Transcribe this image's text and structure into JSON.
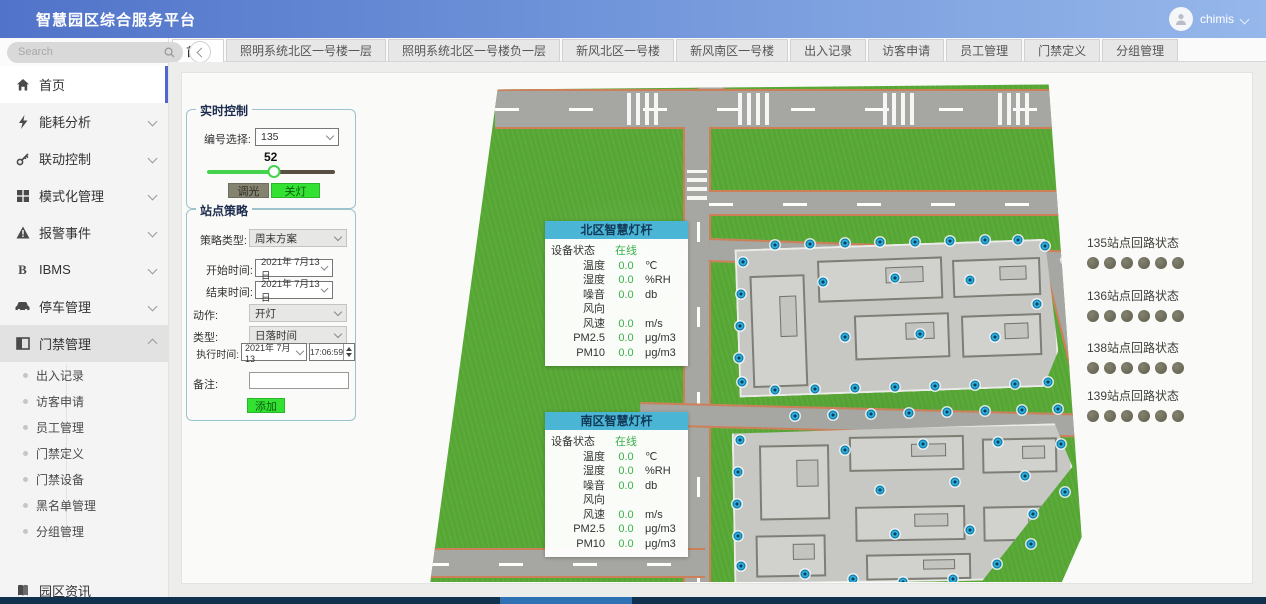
{
  "header": {
    "title": "智慧园区综合服务平台",
    "user_name": "chimis"
  },
  "sidebar": {
    "search_placeholder": "Search",
    "menu": [
      {
        "label": "首页",
        "icon": "home-icon",
        "active": true,
        "expandable": false
      },
      {
        "label": "能耗分析",
        "icon": "bolt-icon",
        "expandable": true
      },
      {
        "label": "联动控制",
        "icon": "key-icon",
        "expandable": true
      },
      {
        "label": "模式化管理",
        "icon": "grid-icon",
        "expandable": true
      },
      {
        "label": "报警事件",
        "icon": "alert-icon",
        "expandable": true
      },
      {
        "label": "IBMS",
        "icon": "ibms-icon",
        "expandable": true
      },
      {
        "label": "停车管理",
        "icon": "car-icon",
        "expandable": true
      },
      {
        "label": "门禁管理",
        "icon": "door-icon",
        "expandable": true,
        "expanded": true
      }
    ],
    "submenu": [
      "出入记录",
      "访客申请",
      "员工管理",
      "门禁定义",
      "门禁设备",
      "黑名单管理",
      "分组管理"
    ],
    "footer_label": "园区资讯"
  },
  "tabs": {
    "active_index": 0,
    "items": [
      "首页",
      "照明系统北区一号楼一层",
      "照明系统北区一号楼负一层",
      "新风北区一号楼",
      "新风南区一号楼",
      "出入记录",
      "访客申请",
      "员工管理",
      "门禁定义",
      "分组管理"
    ]
  },
  "realtime": {
    "title": "实时控制",
    "select_label": "编号选择:",
    "select_value": "135",
    "slider_value": "52",
    "dim_button": "调光",
    "off_button": "关灯"
  },
  "strategy": {
    "title": "站点策略",
    "type_label": "策略类型:",
    "type_value": "周末方案",
    "start_label": "开始时间:",
    "start_value": "2021年 7月13日",
    "end_label": "结束时间:",
    "end_value": "2021年 7月13日",
    "action_label": "动作:",
    "action_value": "开灯",
    "kind_label": "类型:",
    "kind_value": "日落时间",
    "exec_label": "执行时间:",
    "exec_date": "2021年 7月13",
    "exec_time": "17:06:59",
    "note_label": "备注:",
    "note_value": "",
    "add_button": "添加"
  },
  "poles": [
    {
      "title": "北区智慧灯杆",
      "rows": [
        {
          "label": "设备状态",
          "value": "在线",
          "unit": ""
        },
        {
          "label": "温度",
          "value": "0.0",
          "unit": "℃"
        },
        {
          "label": "湿度",
          "value": "0.0",
          "unit": "%RH"
        },
        {
          "label": "噪音",
          "value": "0.0",
          "unit": "db"
        },
        {
          "label": "风向",
          "value": "",
          "unit": ""
        },
        {
          "label": "风速",
          "value": "0.0",
          "unit": "m/s"
        },
        {
          "label": "PM2.5",
          "value": "0.0",
          "unit": "μg/m3"
        },
        {
          "label": "PM10",
          "value": "0.0",
          "unit": "μg/m3"
        }
      ]
    },
    {
      "title": "南区智慧灯杆",
      "rows": [
        {
          "label": "设备状态",
          "value": "在线",
          "unit": ""
        },
        {
          "label": "温度",
          "value": "0.0",
          "unit": "℃"
        },
        {
          "label": "湿度",
          "value": "0.0",
          "unit": "%RH"
        },
        {
          "label": "噪音",
          "value": "0.0",
          "unit": "db"
        },
        {
          "label": "风向",
          "value": "",
          "unit": ""
        },
        {
          "label": "风速",
          "value": "0.0",
          "unit": "m/s"
        },
        {
          "label": "PM2.5",
          "value": "0.0",
          "unit": "μg/m3"
        },
        {
          "label": "PM10",
          "value": "0.0",
          "unit": "μg/m3"
        }
      ]
    }
  ],
  "circuit_status": [
    {
      "label": "135站点回路状态",
      "dots": 6
    },
    {
      "label": "136站点回路状态",
      "dots": 6
    },
    {
      "label": "138站点回路状态",
      "dots": 6
    },
    {
      "label": "139站点回路状态",
      "dots": 6
    }
  ],
  "colors": {
    "value_green": "#3cb04c",
    "pole_header_cyan": "#4ab5d5",
    "button_green": "#33e133",
    "header_blue_start": "#5173c9",
    "header_blue_end": "#96b7ea"
  }
}
